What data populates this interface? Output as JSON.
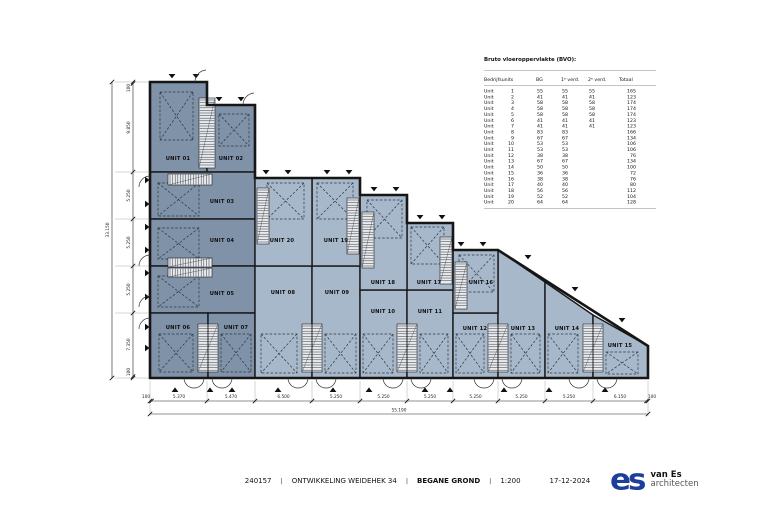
{
  "plan": {
    "units": [
      {
        "id": "u01",
        "label": "UNIT 01"
      },
      {
        "id": "u02",
        "label": "UNIT 02"
      },
      {
        "id": "u03",
        "label": "UNIT 03"
      },
      {
        "id": "u04",
        "label": "UNIT 04"
      },
      {
        "id": "u05",
        "label": "UNIT 05"
      },
      {
        "id": "u06",
        "label": "UNIT 06"
      },
      {
        "id": "u07",
        "label": "UNIT 07"
      },
      {
        "id": "u08",
        "label": "UNIT 08"
      },
      {
        "id": "u09",
        "label": "UNIT 09"
      },
      {
        "id": "u10",
        "label": "UNIT 10"
      },
      {
        "id": "u11",
        "label": "UNIT 11"
      },
      {
        "id": "u12",
        "label": "UNIT 12"
      },
      {
        "id": "u13",
        "label": "UNIT 13"
      },
      {
        "id": "u14",
        "label": "UNIT 14"
      },
      {
        "id": "u15",
        "label": "UNIT 15"
      },
      {
        "id": "u16",
        "label": "UNIT 16"
      },
      {
        "id": "u17",
        "label": "UNIT 17"
      },
      {
        "id": "u18",
        "label": "UNIT 18"
      },
      {
        "id": "u19",
        "label": "UNIT 19"
      },
      {
        "id": "u20",
        "label": "UNIT 20"
      }
    ]
  },
  "table": {
    "title": "Bruto vloeroppervlakte (BVO):",
    "columns": [
      "Bedrijfsunits",
      "BG",
      "1ᵉ verd.",
      "2ᵉ verd.",
      "Totaal"
    ],
    "rows": [
      {
        "unit": "Unit 1",
        "bg": "55",
        "v1": "55",
        "v2": "55",
        "total": "165"
      },
      {
        "unit": "Unit 2",
        "bg": "41",
        "v1": "41",
        "v2": "41",
        "total": "123"
      },
      {
        "unit": "Unit 3",
        "bg": "58",
        "v1": "58",
        "v2": "58",
        "total": "174"
      },
      {
        "unit": "Unit 4",
        "bg": "58",
        "v1": "58",
        "v2": "58",
        "total": "174"
      },
      {
        "unit": "Unit 5",
        "bg": "58",
        "v1": "58",
        "v2": "58",
        "total": "174"
      },
      {
        "unit": "Unit 6",
        "bg": "41",
        "v1": "41",
        "v2": "41",
        "total": "123"
      },
      {
        "unit": "Unit 7",
        "bg": "41",
        "v1": "41",
        "v2": "41",
        "total": "123"
      },
      {
        "unit": "Unit 8",
        "bg": "83",
        "v1": "83",
        "v2": "",
        "total": "166"
      },
      {
        "unit": "Unit 9",
        "bg": "67",
        "v1": "67",
        "v2": "",
        "total": "134"
      },
      {
        "unit": "Unit 10",
        "bg": "53",
        "v1": "53",
        "v2": "",
        "total": "106"
      },
      {
        "unit": "Unit 11",
        "bg": "53",
        "v1": "53",
        "v2": "",
        "total": "106"
      },
      {
        "unit": "Unit 12",
        "bg": "38",
        "v1": "38",
        "v2": "",
        "total": "76"
      },
      {
        "unit": "Unit 13",
        "bg": "67",
        "v1": "67",
        "v2": "",
        "total": "134"
      },
      {
        "unit": "Unit 14",
        "bg": "50",
        "v1": "50",
        "v2": "",
        "total": "100"
      },
      {
        "unit": "Unit 15",
        "bg": "36",
        "v1": "36",
        "v2": "",
        "total": "72"
      },
      {
        "unit": "Unit 16",
        "bg": "38",
        "v1": "38",
        "v2": "",
        "total": "76"
      },
      {
        "unit": "Unit 17",
        "bg": "40",
        "v1": "40",
        "v2": "",
        "total": "80"
      },
      {
        "unit": "Unit 18",
        "bg": "56",
        "v1": "56",
        "v2": "",
        "total": "112"
      },
      {
        "unit": "Unit 19",
        "bg": "52",
        "v1": "52",
        "v2": "",
        "total": "104"
      },
      {
        "unit": "Unit 20",
        "bg": "64",
        "v1": "64",
        "v2": "",
        "total": "128"
      }
    ]
  },
  "dims": {
    "left": [
      "100",
      "9.850",
      "5.250",
      "5.250",
      "5.250",
      "7.350",
      "100"
    ],
    "left_total": "33.150",
    "bottom": [
      "100",
      "5.370",
      "5.470",
      "6.500",
      "5.250",
      "5.250",
      "5.250",
      "5.250",
      "5.250",
      "5.250",
      "6.150",
      "100"
    ],
    "bottom_total": "55.190"
  },
  "titlebar": {
    "project": "240157",
    "sep": "|",
    "title": "ONTWIKKELING WEIDEHEK 34",
    "floor": "BEGANE GROND",
    "scale": "1:200",
    "date": "17-12-2024"
  },
  "logo": {
    "mark": "es",
    "name": "van Es",
    "sub": "architecten"
  },
  "colors": {
    "unit_dark": "#7f92a8",
    "unit_light": "#a7b8ca",
    "wall": "#161616",
    "logo_blue": "#1d3e9b"
  }
}
